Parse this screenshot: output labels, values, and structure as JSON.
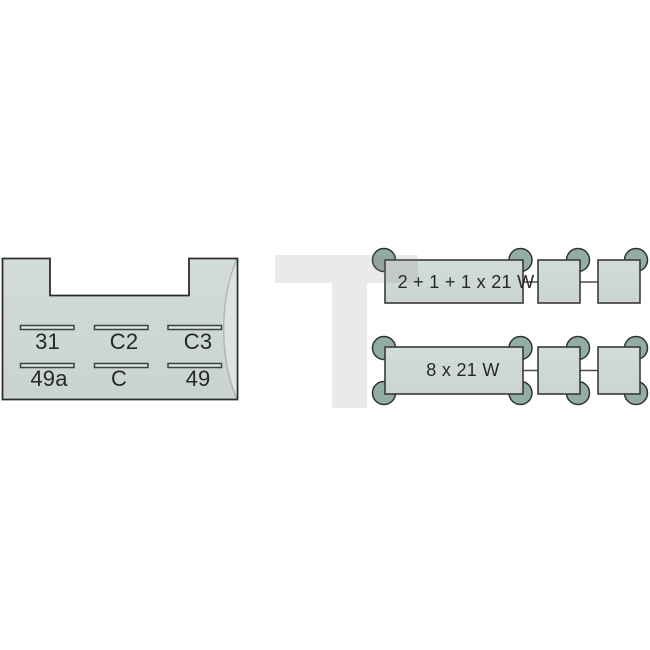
{
  "diagram": {
    "relay_base": {
      "pin_row_top": [
        "31",
        "C2",
        "C3"
      ],
      "pin_row_bottom": [
        "49a",
        "C",
        "49"
      ]
    },
    "load_diagrams": [
      {
        "rating": "2 + 1 + 1 x 21 W"
      },
      {
        "rating": "8 x 21 W"
      }
    ],
    "watermark_letter": "T",
    "colors": {
      "background": "#ffffff",
      "body_fill": "#cdd8d2",
      "terminal_fill": "#92ada4",
      "outline": "#2d2d2d",
      "slot_fill": "#dee6e2",
      "label_text": "#272727",
      "watermark": "#eaeaea"
    }
  }
}
